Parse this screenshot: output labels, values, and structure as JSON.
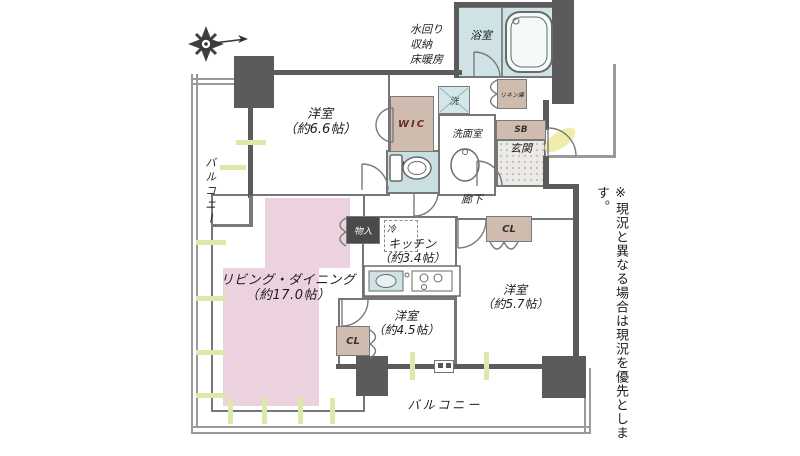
{
  "plan": {
    "title_hint": "apartment-floor-plan",
    "compass_icon": "compass-rose-with-north-arrow",
    "equipment_note": {
      "line1": "水回り",
      "line2": "収納",
      "line3": "床暖房"
    },
    "disclaimer": "※現況と異なる場合は現況を優先とします。",
    "rooms": {
      "bedroom_66": {
        "label": "洋室",
        "size": "（約6.6帖）"
      },
      "living_dining": {
        "label": "リビング・ダイニング",
        "size": "（約17.0帖）"
      },
      "kitchen": {
        "label": "キッチン",
        "size": "（約3.4帖）"
      },
      "bedroom_45": {
        "label": "洋室",
        "size": "（約4.5帖）"
      },
      "bedroom_57": {
        "label": "洋室",
        "size": "（約5.7帖）"
      },
      "bathroom": {
        "label": "浴室"
      },
      "washroom": {
        "label": "洗面室"
      },
      "toilet": {
        "label": "トイレ"
      },
      "hallway": {
        "label": "廊下"
      },
      "entrance": {
        "label": "玄関"
      },
      "balcony_left": {
        "label": "バルコニー"
      },
      "balcony_bottom": {
        "label": "バルコニー"
      }
    },
    "storage": {
      "wic": "WIC",
      "sb": "SB",
      "cl_57": "CL",
      "cl_45": "CL",
      "monoire": "物入",
      "linen": "リネン庫",
      "laundry": "洗",
      "fridge": "冷"
    },
    "colors": {
      "living_fill": "#ecd2de",
      "storage_fill": "#cfbcae",
      "water_fill": "#cfe3e6",
      "wall_dark": "#5b5b5b",
      "window_marker": "#dde8a9"
    }
  }
}
